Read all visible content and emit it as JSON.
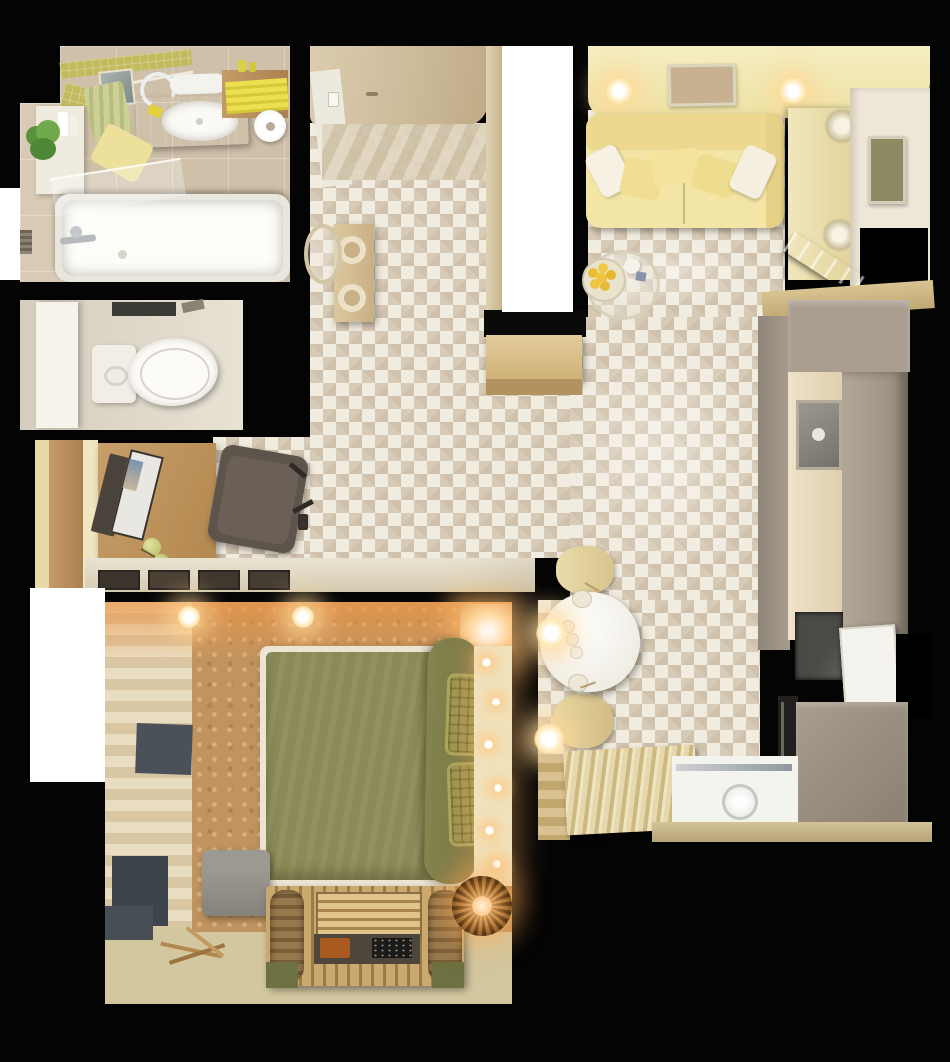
{
  "scene": {
    "title": "Studio apartment - photorealistic top-down 3D floor plan render",
    "view": "top-down",
    "background_color": "#000000",
    "window_cutout_count": 3
  },
  "palette": {
    "walls_void": "#000000",
    "herringbone_floor_light": "#f1ece0",
    "herringbone_floor_shadow": "#d7cab6",
    "sofa_yellow": "#f2e5a5",
    "ceiling_pale_yellow": "#f3ecc0",
    "duvet_green": "#8b8b57",
    "pillow_plaid_green": "#97934f",
    "cabinet_taupe": "#a79c8d",
    "counter_cream": "#ecdfc4",
    "oak_wood": "#bd9563",
    "bathroom_mosaic_accent": "#c3ba60",
    "bathroom_tile_beige": "#cfc0a9",
    "bedroom_floor_tan": "#c0935f",
    "bedroom_floor_pale": "#d3c79f",
    "slate_accent_panel": "#4b5158",
    "warm_glow": "#ffcf8e",
    "white_fixture": "#f6f3ea"
  },
  "rooms": {
    "bathroom": {
      "label": "Bathroom",
      "items": [
        "bathtub",
        "glass-screen",
        "wood-vanity",
        "white-basin",
        "mirror",
        "towel-rail-green-towel",
        "yellow-striped-towels",
        "toilet-paper-roll",
        "shelf-unit",
        "green-plant",
        "yellow-towel-on-tub",
        "mosaic-accent-band"
      ]
    },
    "toilet": {
      "label": "Toilet room",
      "items": [
        "toilet",
        "tall-white-cabinet",
        "dark-ceiling-light"
      ]
    },
    "workspace": {
      "label": "Desk nook",
      "items": [
        "oak-desk",
        "open-laptop",
        "green-apples",
        "dark-office-chair",
        "picture-ledge-with-frames"
      ]
    },
    "bedroom": {
      "label": "Bedroom",
      "items": [
        "double-bed-green-duvet",
        "two-plaid-pillows",
        "headboard-string-lights",
        "plank-accent-wall",
        "slate-wall-panels",
        "gray-pouf",
        "slatted-bench-with-blanket-rolls",
        "breakfast-tray",
        "wicker-pendant-lamp",
        "driftwood-decor",
        "ceiling-spotlights",
        "corner-glow-lamp"
      ]
    },
    "hallway": {
      "label": "Hallway / entry",
      "items": [
        "entry-door",
        "doormat",
        "console-with-two-vases",
        "oval-wall-mirror",
        "wardrobe-divider",
        "wooden-storage-bench",
        "herringbone-floor"
      ]
    },
    "living": {
      "label": "Living room",
      "items": [
        "yellow-sofa",
        "five-throw-pillows",
        "two-wall-sconces",
        "framed-art-top",
        "framed-art-right",
        "glass-coffee-table",
        "bowl-of-lemons",
        "white-jug",
        "sideboard",
        "two-glass-vases",
        "open-balcony-door",
        "window-void"
      ]
    },
    "kitchen": {
      "label": "Kitchen",
      "items": [
        "taupe-cabinet-run",
        "cream-countertop",
        "undermount-sink",
        "dark-cooktop",
        "built-in-oven",
        "open-window-sash",
        "island-block",
        "wood-beam"
      ]
    },
    "dining": {
      "label": "Dining area",
      "items": [
        "round-white-table",
        "two-cream-chairs",
        "two-glow-pendants",
        "plates-with-spoons",
        "three-cups"
      ]
    },
    "balcony": {
      "label": "Balcony nook",
      "items": [
        "white-floor",
        "metal-threshold-rail",
        "glass-sconce",
        "striped-runner-rug",
        "wood-plank-steps",
        "tan-threshold-strip"
      ]
    }
  }
}
